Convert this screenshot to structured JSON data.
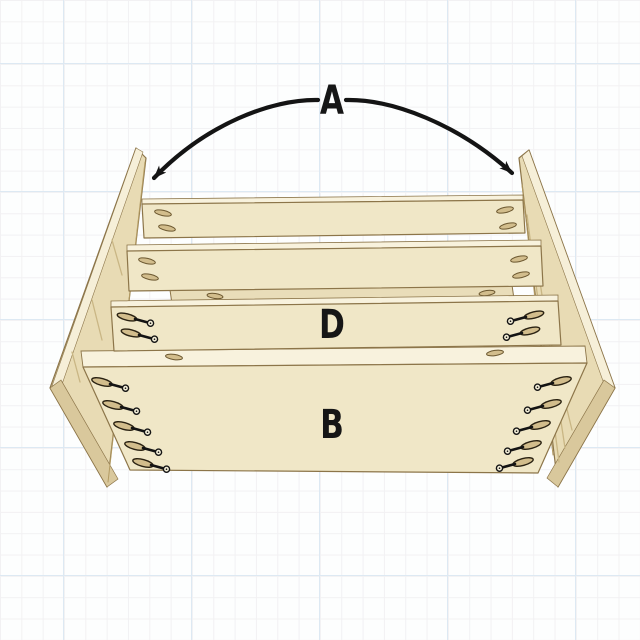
{
  "diagram": {
    "type": "furniture-assembly-illustration",
    "labels": {
      "a": "A",
      "d": "D",
      "b": "B"
    },
    "colors": {
      "background": "#fdfefe",
      "grid_minor": "#f2f1f3",
      "grid_major": "#dde9f3",
      "board_face": "#f0e7c7",
      "board_top_edge": "#f8f2dd",
      "panel_face": "#e8dbb4",
      "panel_edge": "#f6efd8",
      "panel_bottom_edge": "#d9c89c",
      "wood_outline": "#8c7549",
      "pocket_hole_fill": "#d2bd8c",
      "screw_and_arrow": "#141414"
    },
    "parts": {
      "side_panels": 2,
      "narrow_cross_rails": 3,
      "wide_bottom_board": 1,
      "pocket_screws_visible": 14,
      "pocket_holes_visible": 26
    }
  }
}
